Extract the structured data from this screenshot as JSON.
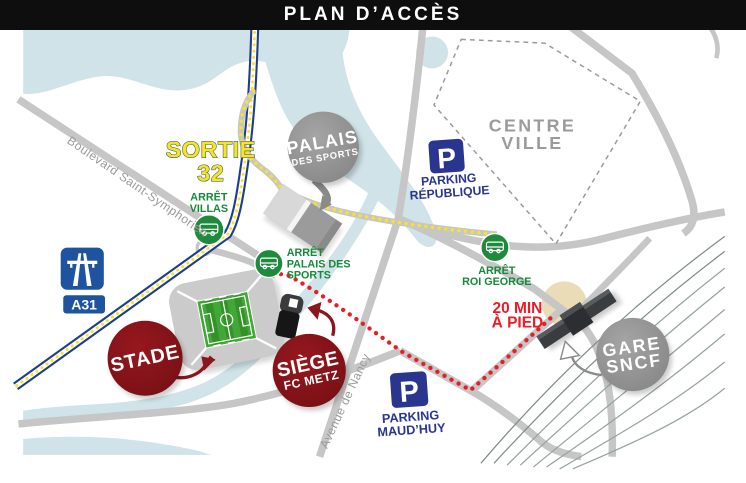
{
  "header": {
    "title": "PLAN D’ACCÈS"
  },
  "labels": {
    "sortie_line1": "SORTIE",
    "sortie_line2": "32",
    "boulevard": "Boulevard Saint-Symphorien",
    "avenue": "Avenue de Nancy",
    "centre_ville_line1": "CENTRE",
    "centre_ville_line2": "VILLE",
    "walk_line1": "20 MIN",
    "walk_line2": "À PIED"
  },
  "motorway": {
    "badge": "A31"
  },
  "stops": {
    "villas": {
      "line1": "ARRÊT",
      "line2": "VILLAS"
    },
    "palais": {
      "line1": "ARRÊT",
      "line2": "PALAIS DES",
      "line3": "SPORTS"
    },
    "roi_george": {
      "line1": "ARRÊT",
      "line2": "ROI GEORGE"
    }
  },
  "parkings": {
    "republique": {
      "p": "P",
      "line1": "PARKING",
      "line2": "RÉPUBLIQUE"
    },
    "maudhuy": {
      "p": "P",
      "line1": "PARKING",
      "line2": "MAUD’HUY"
    }
  },
  "bubbles": {
    "palais_sports": {
      "line1": "PALAIS",
      "line2": "DES SPORTS"
    },
    "stade": {
      "line1": "STADE"
    },
    "siege": {
      "line1": "SIÈGE",
      "line2": "FC METZ"
    },
    "gare": {
      "line1": "GARE",
      "line2": "SNCF"
    }
  },
  "colors": {
    "header_bg": "#0e0e0e",
    "river": "#cfe3e8",
    "road": "#c6c6c6",
    "highway_blue": "#1c3e92",
    "route_yellow": "#ffe415",
    "walk_red": "#ea1c24",
    "stop_green": "#1e8b3c",
    "parking_navy": "#2a3590",
    "bubble_gray": "#939393",
    "bubble_dark_red": "#8b161c",
    "station_dark": "#3a3d40",
    "forecourt_tan": "#e9dcb6",
    "sortie_yellow": "#f8e713",
    "street_label_gray": "#9a9a9a"
  }
}
